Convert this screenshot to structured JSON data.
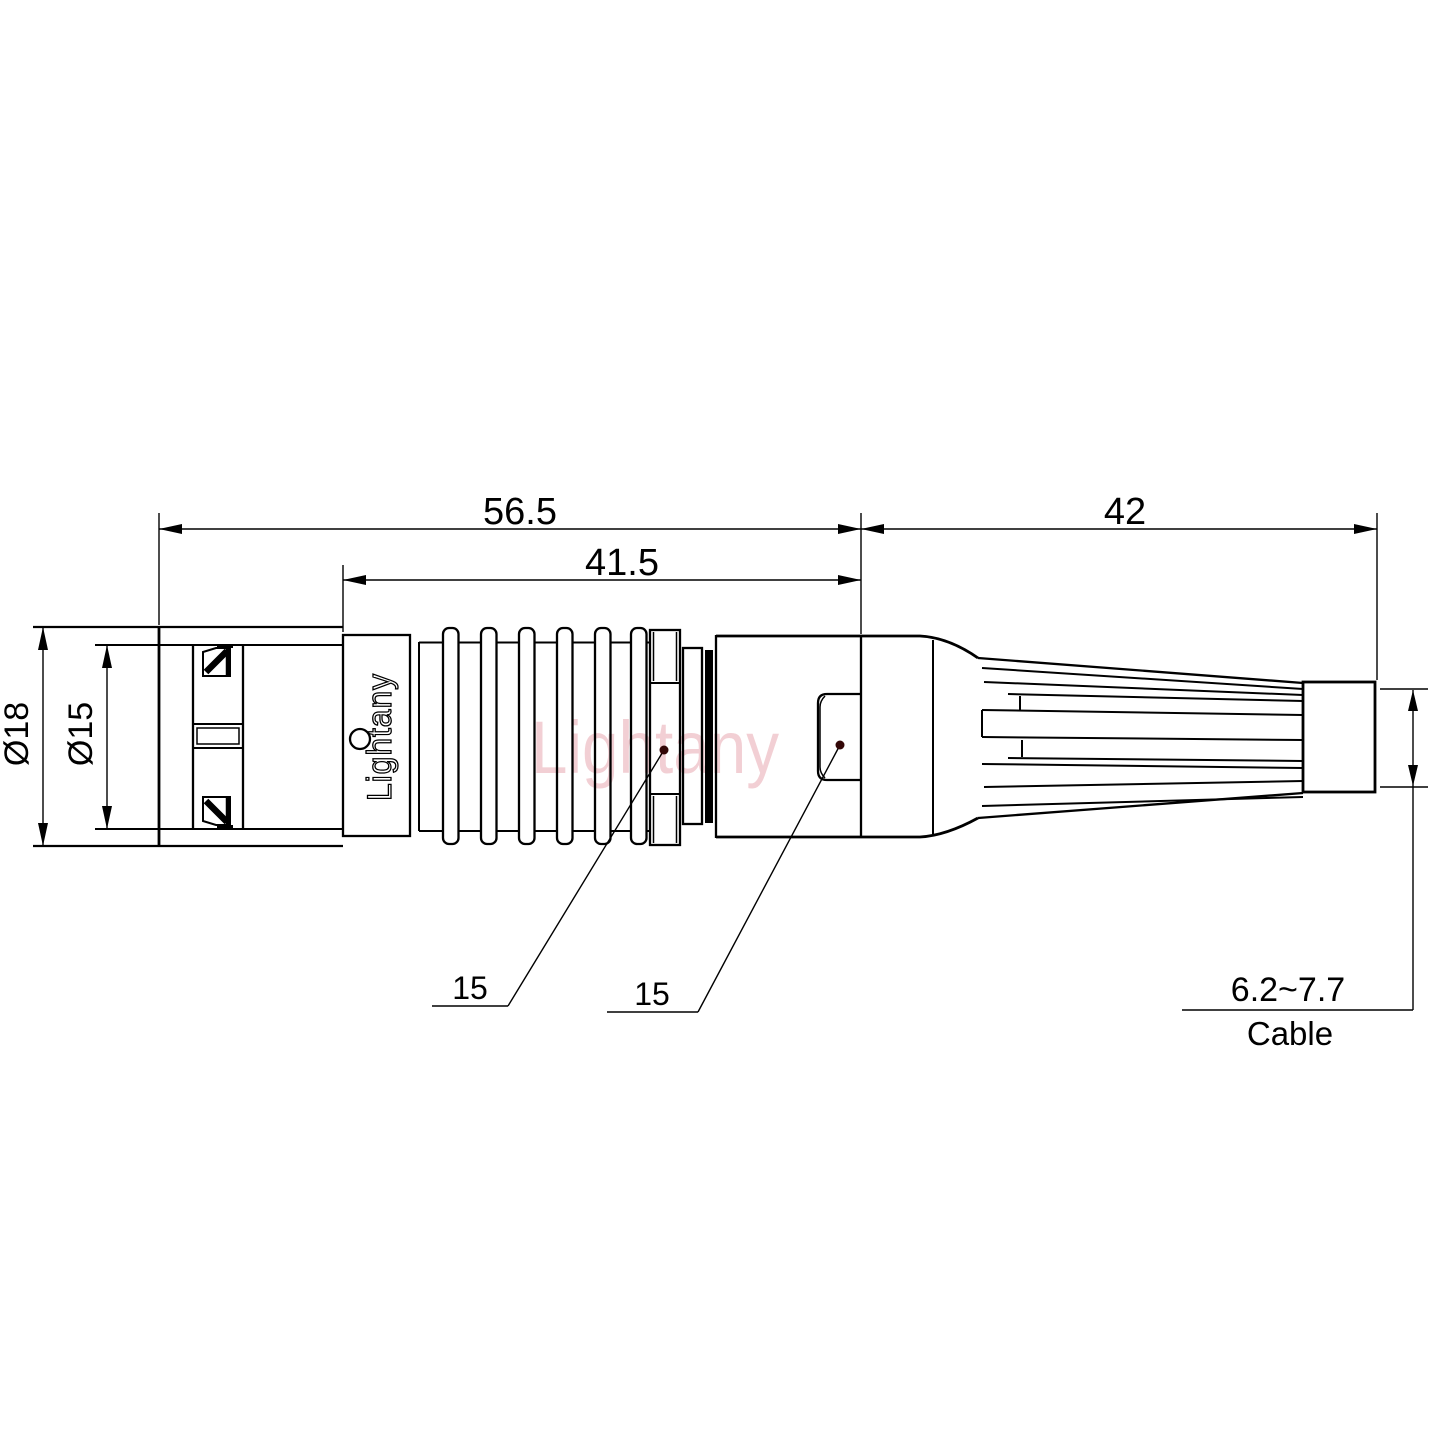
{
  "drawing": {
    "brand_on_body": "Lightany",
    "watermark": "Lightany",
    "colors": {
      "line": "#000000",
      "watermark_pink": "#eec0c6",
      "leader_dot": "#330707",
      "background": "#ffffff"
    },
    "dimensions": {
      "overall_length": "56.5",
      "body_length": "41.5",
      "boot_length": "42",
      "outer_diameter": "Ø18",
      "inner_diameter": "Ø15",
      "callout_nut": "15",
      "callout_backshell": "15",
      "cable_range": "6.2~7.7",
      "cable_label": "Cable"
    }
  }
}
